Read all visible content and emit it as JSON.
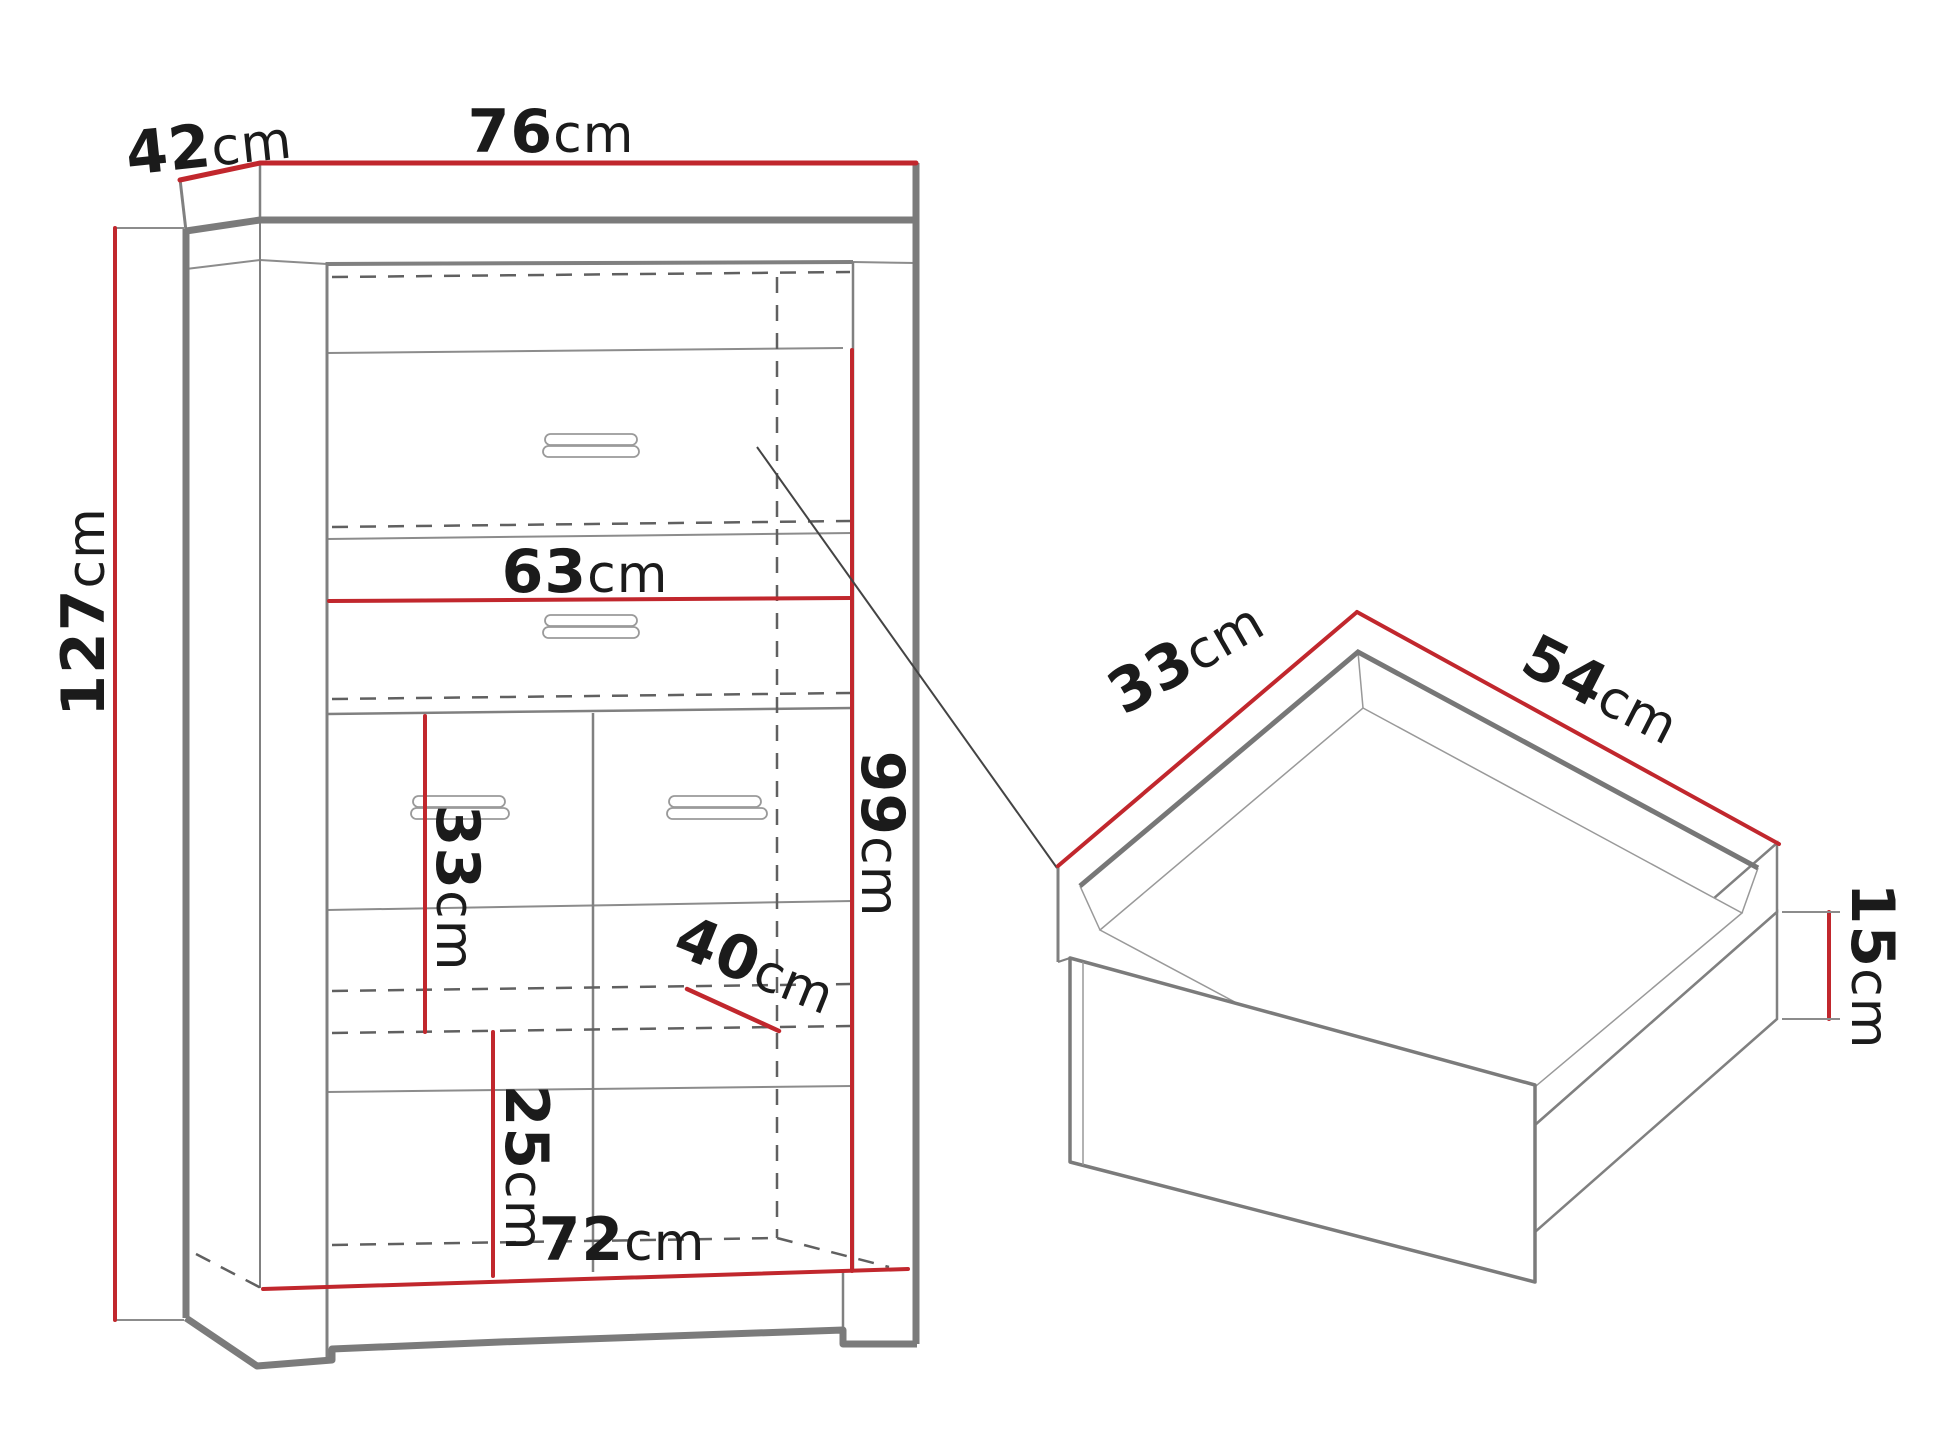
{
  "diagram": {
    "type": "furniture-dimension-drawing",
    "views": [
      "cabinet-front-view",
      "drawer-isometric-detail"
    ]
  },
  "colors": {
    "dimension_red": "#c1272d",
    "outline_grey": "#7b7b7b",
    "thin_grey": "#8c8c8c",
    "dashed_grey": "#606060",
    "text_black": "#1b1b1b",
    "background": "#ffffff"
  },
  "cabinet": {
    "dimensions": {
      "depth": {
        "num": "42",
        "unit": "cm"
      },
      "width": {
        "num": "76",
        "unit": "cm"
      },
      "height": {
        "num": "127",
        "unit": "cm"
      },
      "drawer_width": {
        "num": "63",
        "unit": "cm"
      },
      "interior_height": {
        "num": "99",
        "unit": "cm"
      },
      "shelf_spacing": {
        "num": "33",
        "unit": "cm"
      },
      "compartment": {
        "num": "40",
        "unit": "cm"
      },
      "bottom_spacing": {
        "num": "25",
        "unit": "cm"
      },
      "interior_width": {
        "num": "72",
        "unit": "cm"
      }
    }
  },
  "drawer": {
    "dimensions": {
      "depth": {
        "num": "33",
        "unit": "cm"
      },
      "width": {
        "num": "54",
        "unit": "cm"
      },
      "height": {
        "num": "15",
        "unit": "cm"
      }
    }
  }
}
